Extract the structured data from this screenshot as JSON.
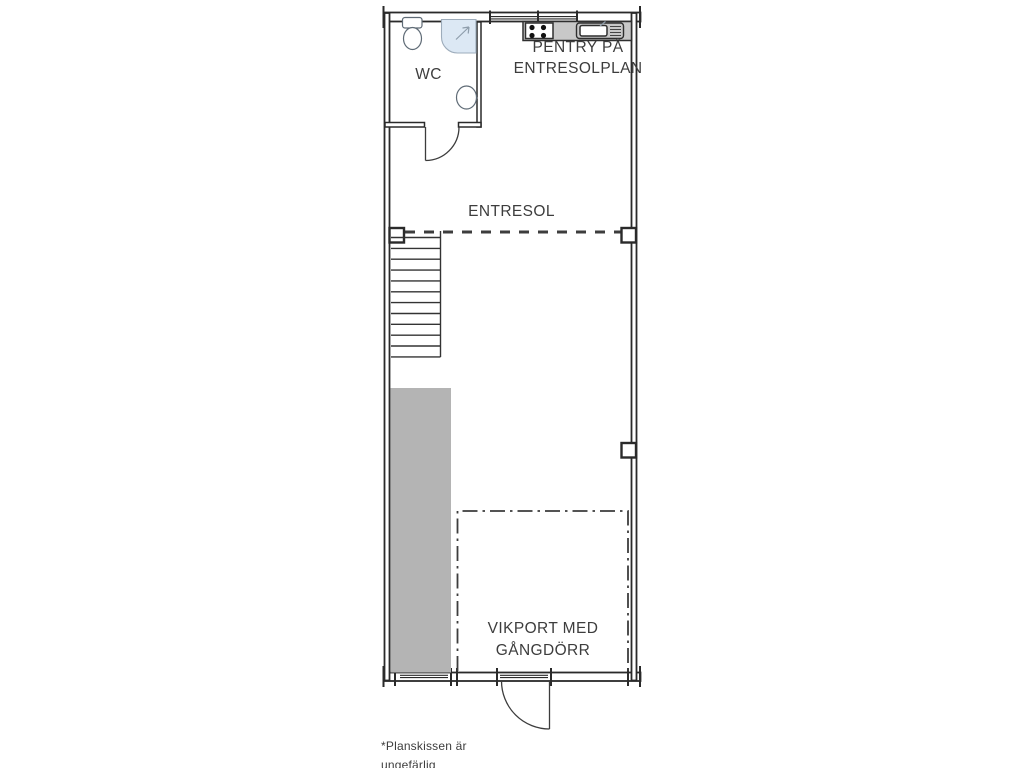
{
  "title": "Planskiss entresolplan",
  "colors": {
    "wall": "#2a2a2a",
    "text": "#3d3d3d",
    "dash": "#3d3d3d",
    "gray_fill": "#b4b4b4",
    "counter_fill": "#c8c8c8",
    "shower_fill": "#dce8f4",
    "fixture_stroke": "#5f6b76"
  },
  "labels": {
    "wc": "WC",
    "pentry": {
      "line1": "PENTRY PÅ",
      "line2": "ENTRESOLPLAN"
    },
    "entresol": "ENTRESOL",
    "vikport": {
      "line1": "VIKPORT MED",
      "line2": "GÅNGDÖRR"
    },
    "footnote": {
      "line1": "*Planskissen är",
      "line2": "ungefärlig"
    }
  },
  "icons": {
    "toilet": "toilet-icon",
    "shower": "shower-icon",
    "washbasin": "washbasin-icon",
    "stove": "stove-icon",
    "kitchen_sink": "kitchen-sink-icon",
    "stairs": "stairs-icon",
    "wc_door": "door-swing-icon",
    "entry_door": "door-swing-icon"
  }
}
